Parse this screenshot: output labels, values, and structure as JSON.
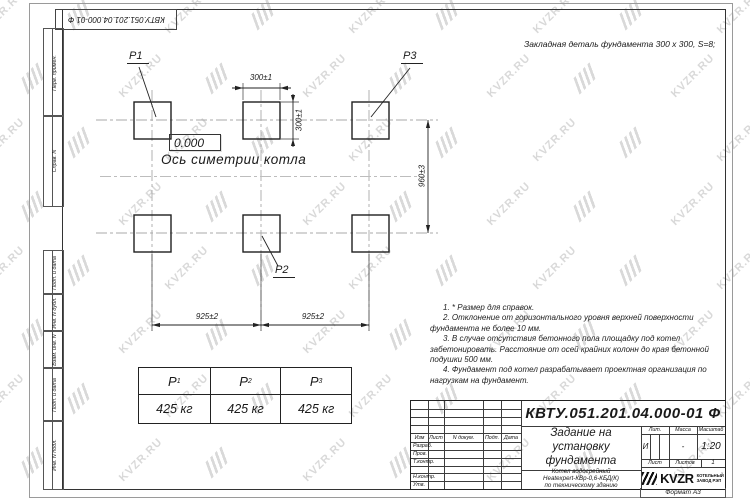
{
  "watermark": {
    "text": "KVZR.RU"
  },
  "frame": {
    "doc_number_top": "КВТУ.051.201.04.000-01 Ф",
    "format_label": "Формат А3",
    "side_labels": [
      "Перв. примен.",
      "Справ. N",
      "Подп. и дата",
      "Инв. N дубл.",
      "Взам. инв. N",
      "Подп. и дата",
      "Инв. N подл."
    ]
  },
  "drawing": {
    "detail_note": "Закладная деталь фундамента  300 x 300,  S=8;",
    "elevation_mark": "0.000",
    "axis_label": "Ось симетрии котла",
    "pad_labels": {
      "p1": "P1",
      "p2": "P2",
      "p3": "P3"
    },
    "dimensions": {
      "pad_width": "300±1",
      "pad_height": "300±1",
      "row_spacing": "960±3",
      "span_left": "925±2",
      "span_right": "925±2"
    }
  },
  "notes": [
    "1. * Размер для справок.",
    "2. Отклонение от горизонтального уровня верхней поверхности фундамента не более 10 мм.",
    "3. В случае отсутствия бетонного пола площадку под котел забетонировать. Расстояние от осей крайних колонн до края бетонной подушки 500 мм.",
    "4. Фундамент под котел разрабатывает проектная организация по нагрузкам на фундамент."
  ],
  "load_table": {
    "columns": [
      {
        "name": "P",
        "sub": "1"
      },
      {
        "name": "P",
        "sub": "2"
      },
      {
        "name": "P",
        "sub": "3"
      }
    ],
    "values": [
      "425 кг",
      "425 кг",
      "425 кг"
    ]
  },
  "title_block": {
    "doc_number": "КВТУ.051.201.04.000-01 Ф",
    "title_lines": [
      "Задание на",
      "установку",
      "фундамента"
    ],
    "product_lines": [
      "Котел водогрейный",
      "Heatexpert-КВр-0,6-КБД(К)",
      "по техническому зданию"
    ],
    "header_cols": [
      "Изм",
      "Лист",
      "N докум.",
      "Подп.",
      "Дата"
    ],
    "row_labels": [
      "Разраб.",
      "Пров.",
      "Т.контр.",
      "",
      "Н.контр.",
      "Утв."
    ],
    "lit_header": "Лит.",
    "mass_header": "Масса",
    "scale_header": "Масштаб",
    "lit_value": "И",
    "mass_value": "-",
    "scale_value": "1:20",
    "sheet_label": "Лист",
    "sheets_label": "Листов",
    "sheets_value": "1",
    "logo_text": "KVZR",
    "logo_caption": [
      "КОТЕЛЬНЫЙ",
      "ЗАВОД РЭП"
    ]
  }
}
